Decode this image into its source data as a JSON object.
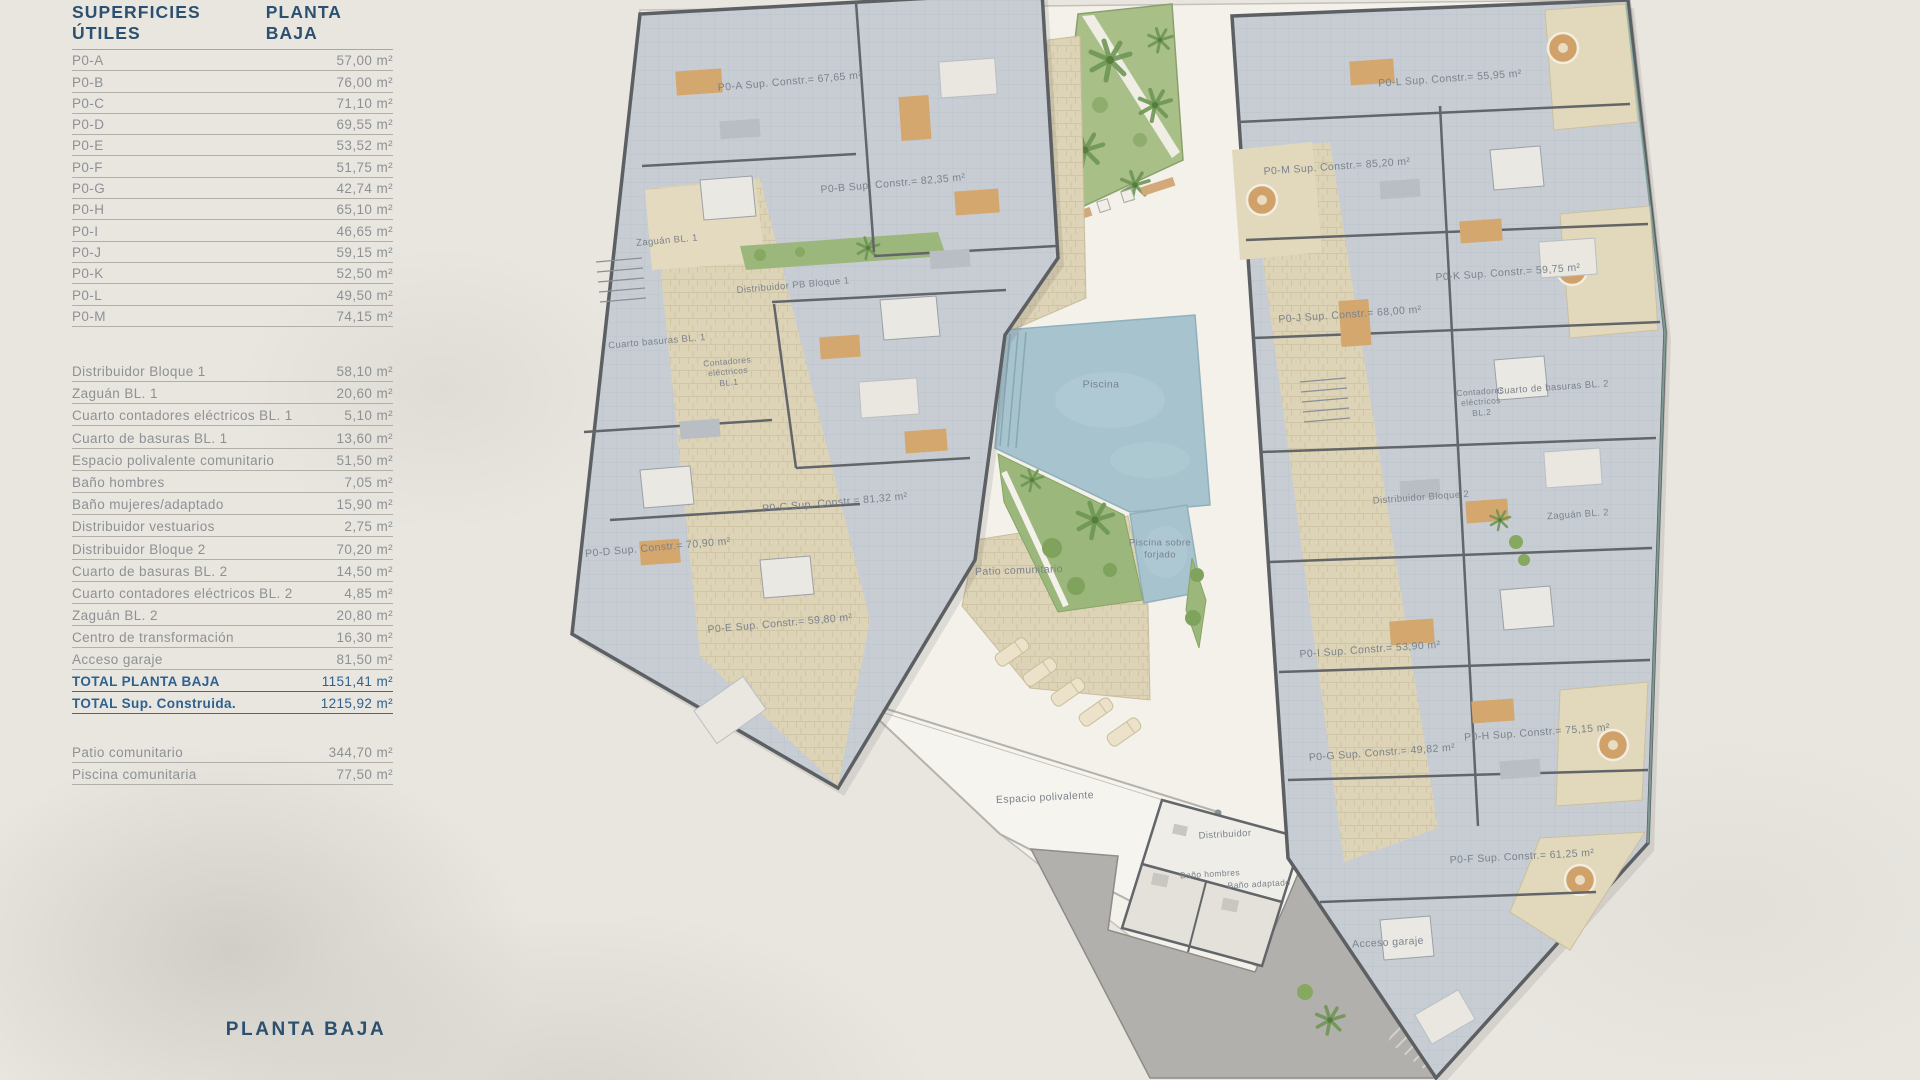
{
  "panel": {
    "header": {
      "left": "SUPERFICIES ÚTILES",
      "right": "PLANTA BAJA"
    },
    "apartments": [
      {
        "label": "P0-A",
        "value": "57,00 m²"
      },
      {
        "label": "P0-B",
        "value": "76,00 m²"
      },
      {
        "label": "P0-C",
        "value": "71,10 m²"
      },
      {
        "label": "P0-D",
        "value": "69,55 m²"
      },
      {
        "label": "P0-E",
        "value": "53,52 m²"
      },
      {
        "label": "P0-F",
        "value": "51,75 m²"
      },
      {
        "label": "P0-G",
        "value": "42,74 m²"
      },
      {
        "label": "P0-H",
        "value": "65,10 m²"
      },
      {
        "label": "P0-I",
        "value": "46,65 m²"
      },
      {
        "label": "P0-J",
        "value": "59,15 m²"
      },
      {
        "label": "P0-K",
        "value": "52,50 m²"
      },
      {
        "label": "P0-L",
        "value": "49,50 m²"
      },
      {
        "label": "P0-M",
        "value": "74,15 m²"
      }
    ],
    "commons": [
      {
        "label": "Distribuidor Bloque 1",
        "value": "58,10 m²"
      },
      {
        "label": "Zaguán BL. 1",
        "value": "20,60 m²"
      },
      {
        "label": "Cuarto contadores eléctricos BL. 1",
        "value": "5,10 m²"
      },
      {
        "label": "Cuarto de basuras BL. 1",
        "value": "13,60 m²"
      },
      {
        "label": "Espacio polivalente comunitario",
        "value": "51,50 m²"
      },
      {
        "label": "Baño hombres",
        "value": "7,05 m²"
      },
      {
        "label": "Baño mujeres/adaptado",
        "value": "15,90 m²"
      },
      {
        "label": "Distribuidor vestuarios",
        "value": "2,75 m²"
      },
      {
        "label": "Distribuidor Bloque 2",
        "value": "70,20 m²"
      },
      {
        "label": "Cuarto de basuras BL. 2",
        "value": "14,50 m²"
      },
      {
        "label": "Cuarto contadores eléctricos BL. 2",
        "value": "4,85 m²"
      },
      {
        "label": "Zaguán BL. 2",
        "value": "20,80 m²"
      },
      {
        "label": "Centro de transformación",
        "value": "16,30 m²"
      },
      {
        "label": "Acceso garaje",
        "value": "81,50 m²"
      }
    ],
    "totals": [
      {
        "label": "TOTAL PLANTA BAJA",
        "value": "1151,41 m²"
      },
      {
        "label": "TOTAL Sup. Construida.",
        "value": "1215,92 m²"
      }
    ],
    "outdoor": [
      {
        "label": "Patio comunitario",
        "value": "344,70 m²"
      },
      {
        "label": "Piscina comunitaria",
        "value": "77,50 m²"
      }
    ],
    "footer": "PLANTA BAJA"
  },
  "plan": {
    "labels": {
      "p0a": "P0-A Sup. Constr.= 67,65 m²",
      "p0b": "P0-B Sup. Constr.= 82,35 m²",
      "p0c": "P0-C Sup. Constr.= 81,32 m²",
      "p0d": "P0-D Sup. Constr.= 70,90 m²",
      "p0e": "P0-E Sup. Constr.= 59,80 m²",
      "p0f": "P0-F Sup. Constr.= 61,25 m²",
      "p0g": "P0-G Sup. Constr.= 49,82 m²",
      "p0h": "P0-H Sup. Constr.= 75,15 m²",
      "p0i": "P0-I Sup. Constr.= 53,90 m²",
      "p0j": "P0-J Sup. Constr.= 68,00 m²",
      "p0k": "P0-K Sup. Constr.= 59,75 m²",
      "p0l": "P0-L Sup. Constr.= 55,95 m²",
      "p0m": "P0-M Sup. Constr.= 85,20 m²",
      "zaguan_bl1": "Zaguán BL. 1",
      "distribuidor_pb_bloque1": "Distribuidor PB Bloque 1",
      "cuarto_basuras_bl1": "Cuarto basuras BL. 1",
      "contadores_bl1": "Contadores\neléctricos\nBL.1",
      "piscina": "Piscina",
      "piscina_forjado": "Piscina sobre\nforjado",
      "patio_comunitario": "Patio comunitario",
      "espacio_polivalente": "Espacio polivalente",
      "distribuidor": "Distribuidor",
      "bano_hombres": "Baño hombres",
      "bano_adaptado": "Baño adaptado",
      "acceso_garaje": "Acceso garaje",
      "cuarto_basuras_bl2": "Cuarto de basuras BL. 2",
      "contadores_bl2": "Contadores\neléctricos\nBL.2",
      "distribuidor_bloque2": "Distribuidor Bloque 2",
      "zaguan_bl2": "Zaguán BL. 2"
    }
  },
  "colors": {
    "heading_navy": "#2c5070",
    "total_blue": "#2f618f",
    "row_gray": "#8d9194",
    "room_fill": "#c8cdd4",
    "wall": "#5d6063",
    "corridor_tan": "#ddd3b6",
    "terrace_tan": "#e2d8bb",
    "garden_green": "#a9bf88",
    "pool_blue": "#a7c3ce",
    "ramp_gray": "#b2b0ac",
    "background": "#e9e6e0",
    "courtyard": "#f3f1ea"
  }
}
